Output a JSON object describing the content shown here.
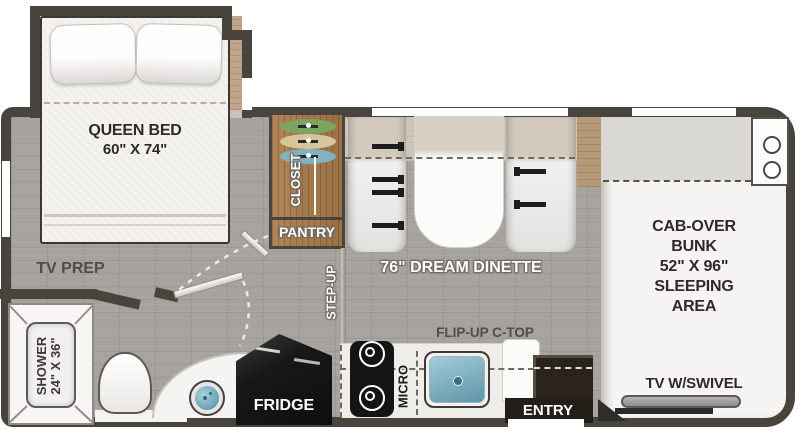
{
  "plan": {
    "bedroom": {
      "bed_label": "QUEEN BED",
      "bed_size": "60\" X 74\"",
      "tv_prep": "TV PREP"
    },
    "bathroom": {
      "shower_label": "SHOWER",
      "shower_size": "24\" X 36\""
    },
    "storage": {
      "closet": "CLOSET",
      "pantry": "PANTRY"
    },
    "dinette": {
      "label": "76\" DREAM DINETTE",
      "step_up": "STEP-UP"
    },
    "kitchen": {
      "flip_up": "FLIP-UP C-TOP",
      "micro": "MICRO",
      "fridge": "FRIDGE",
      "entry": "ENTRY"
    },
    "cab": {
      "line1": "CAB-OVER",
      "line2": "BUNK",
      "line3": "52\" X 96\"",
      "line4": "SLEEPING",
      "line5": "AREA",
      "tv": "TV W/SWIVEL"
    },
    "colors": {
      "wall": "#4a443e",
      "floor": "#a6a29d",
      "closet_wood": "#a2764a",
      "sink_blue": "#6fa9bd",
      "entry_brown": "#2b241d",
      "appliance_black": "#161616"
    }
  }
}
